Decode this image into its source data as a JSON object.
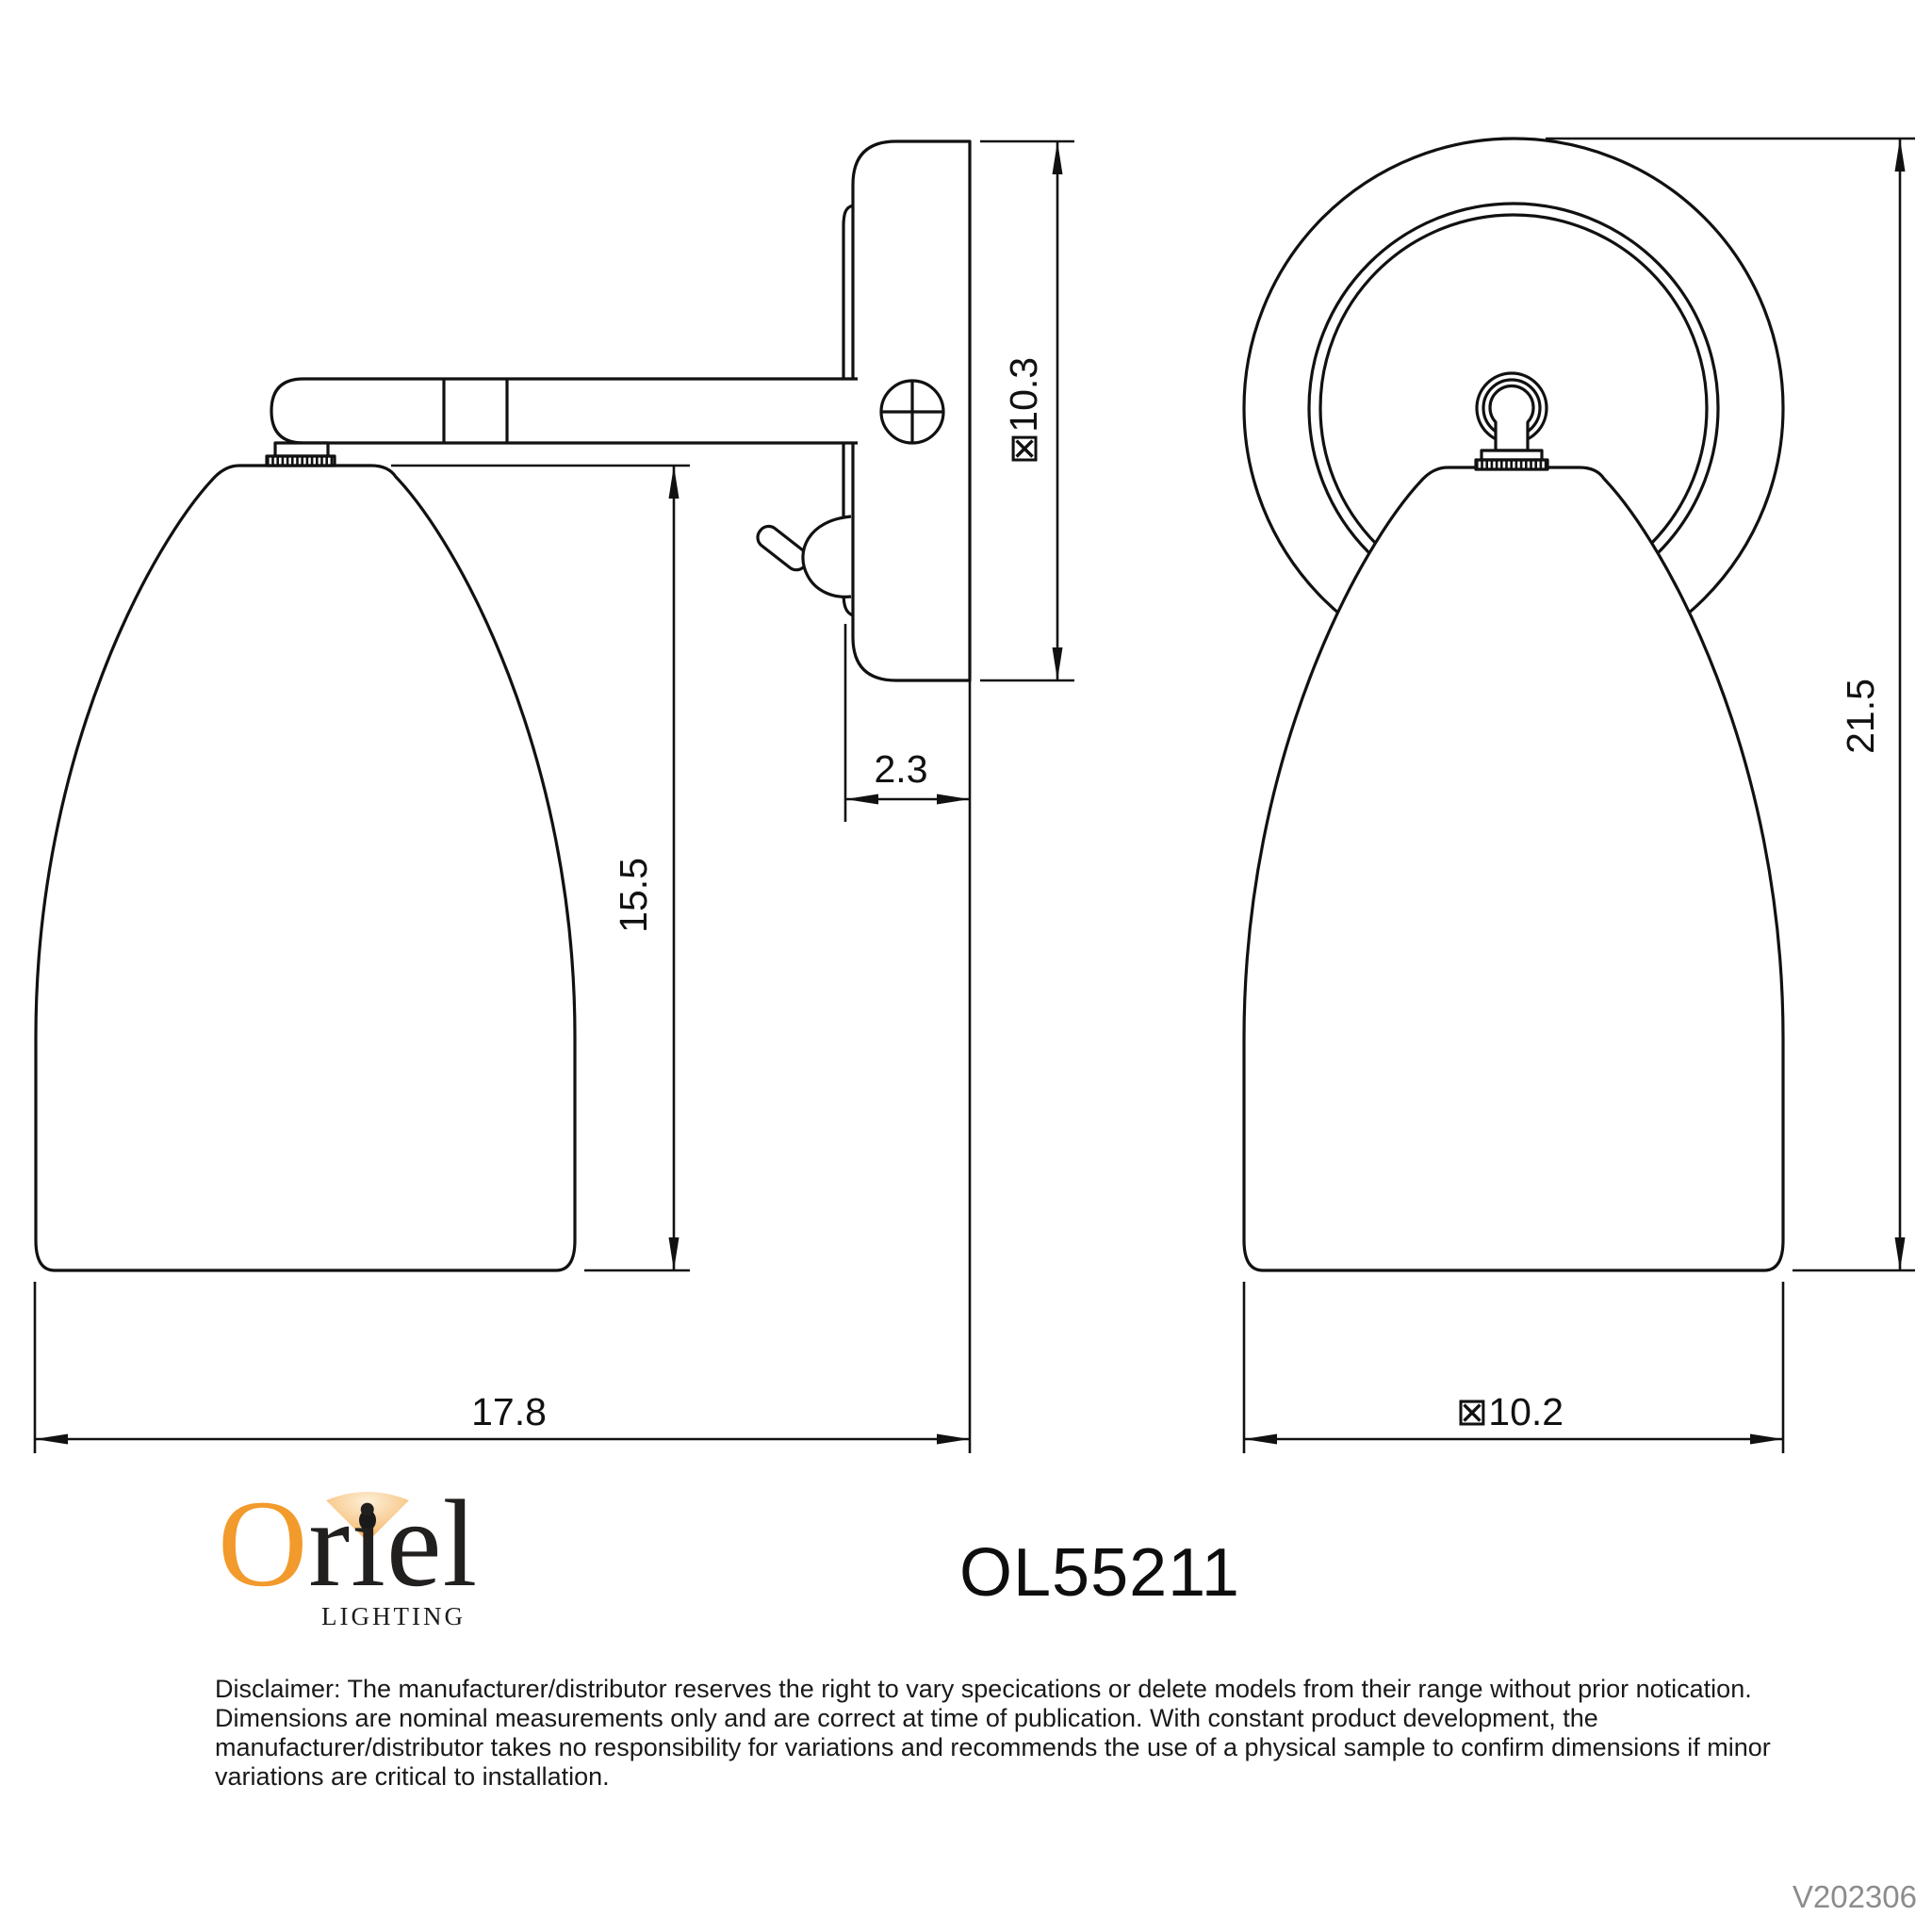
{
  "product": {
    "model": "OL55211",
    "version": "V202306"
  },
  "branding": {
    "logo_o": "O",
    "logo_rest": "riel",
    "logo_subtitle": "LIGHTING",
    "accent_orange": "#F29A2B"
  },
  "dimensions": {
    "side_view": {
      "plate_height": "⊠10.3",
      "plate_depth": "2.3",
      "shade_drop": "15.5",
      "projection": "17.8"
    },
    "front_view": {
      "overall_height": "21.5",
      "shade_diameter": "⊠10.2"
    }
  },
  "disclaimer": {
    "line1": "Disclaimer: The manufacturer/distributor reserves the right to vary specications or delete models from their range without prior notication.",
    "line2": "Dimensions are nominal measurements only and are correct at time of publication. With constant product development, the",
    "line3": "manufacturer/distributor takes no responsibility for variations and recommends the use of a physical sample to confirm dimensions if minor",
    "line4": "variations are critical to installation."
  },
  "colors": {
    "line_color": "#111111",
    "version_gray": "#8c8c8c"
  }
}
